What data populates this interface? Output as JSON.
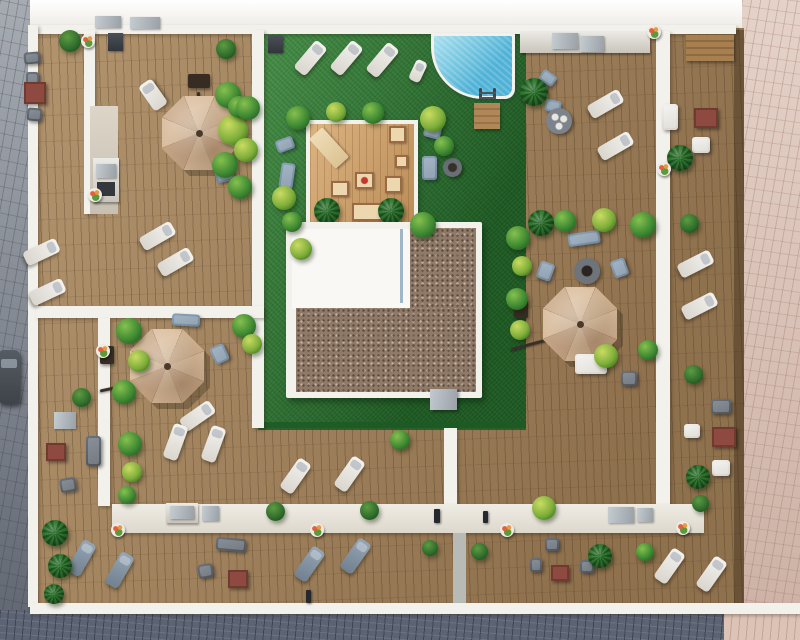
{
  "meta": {
    "title": "Aerial top-down 3D architectural render of a rooftop terrace complex",
    "view": "bird's-eye / plan view",
    "visible_text": "none"
  },
  "colors": {
    "wood": "#a5845c",
    "patio_wood": "#cf9f66",
    "lawn": "#2f7c34",
    "lawn_dark": "#1c5a25",
    "pool": "#4fb2d6",
    "pool_light": "#a9e0ee",
    "white_wall": "#f3f1ec",
    "roof_white": "#f9f8f4",
    "gravel": "#8f7968",
    "street_left": "#9aa0a8",
    "street_bottom": "#5c6372",
    "street_right": "#dcc3b6",
    "umbrella": "#d2b394",
    "red_accent": "#8e4a40",
    "plant": "#3f8a33",
    "plant_light": "#86c04f",
    "plant_dark": "#2a6524"
  },
  "scene": {
    "areas": [
      "gray paver street (left)",
      "dark paver street (bottom)",
      "pink paver street (right)",
      "perimeter wooden roof terraces",
      "central lawn garden",
      "swimming pool with ladder and wooden steps",
      "central wooden lounge patio with floor cushions",
      "building roof: white section plus brown gravel L-section with vent",
      "white dividing walls and rear access walkway"
    ],
    "objects": {
      "octagonal_parasols": 3,
      "sun_loungers_white": 20,
      "sun_loungers_gray": 4,
      "sofas_and_armchairs": 26,
      "fire_pit_tables": 4,
      "red_coffee_tables": 4,
      "round_dining_table": 1,
      "outdoor_kitchen_counters": 6,
      "bushes_and_planters": 41,
      "flower_pots": 9,
      "bollard_lights": 3,
      "parked_car": 1,
      "roof_vent": 1
    }
  }
}
